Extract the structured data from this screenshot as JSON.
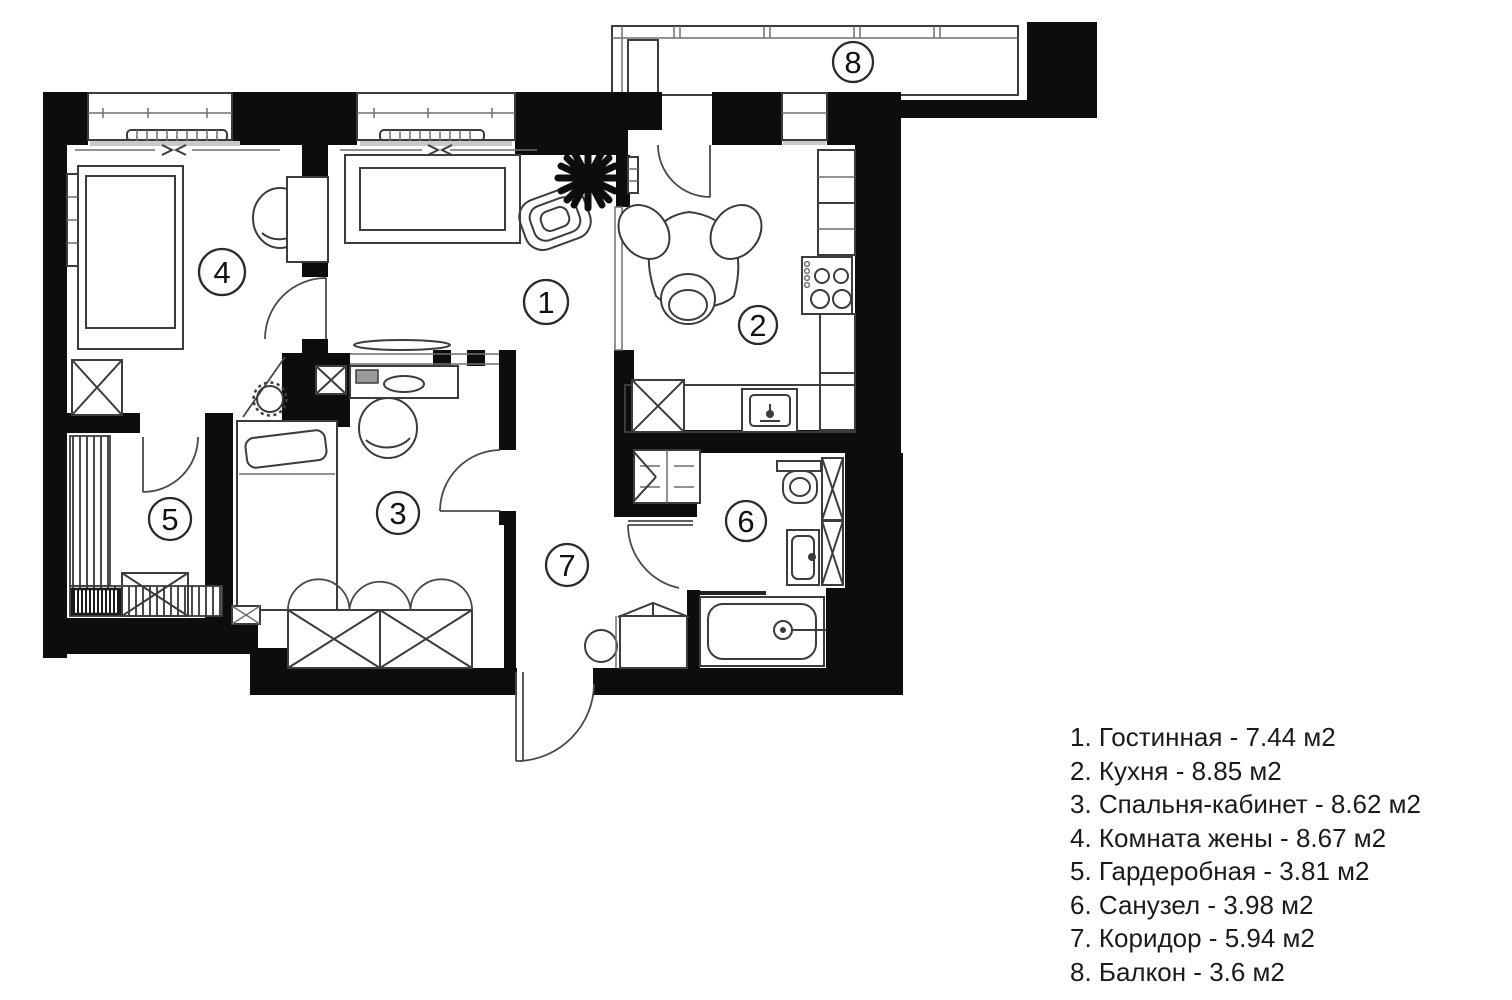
{
  "colors": {
    "wall": "#0d0d0d",
    "furniture_line": "#3c3c3c",
    "text": "#1b1b1b",
    "background": "#ffffff"
  },
  "area_unit": "м2",
  "rooms": [
    {
      "number": "1",
      "name": "Гостинная",
      "area_m2": "7.44",
      "legend_text": "1. Гостинная - 7.44 м2"
    },
    {
      "number": "2",
      "name": "Кухня",
      "area_m2": "8.85",
      "legend_text": "2. Кухня - 8.85 м2"
    },
    {
      "number": "3",
      "name": "Спальня-кабинет",
      "area_m2": "8.62",
      "legend_text": "3. Спальня-кабинет - 8.62 м2"
    },
    {
      "number": "4",
      "name": "Комната жены",
      "area_m2": "8.67",
      "legend_text": "4. Комната жены - 8.67 м2"
    },
    {
      "number": "5",
      "name": "Гардеробная",
      "area_m2": "3.81",
      "legend_text": "5. Гардеробная - 3.81 м2"
    },
    {
      "number": "6",
      "name": "Санузел",
      "area_m2": "3.98",
      "legend_text": "6. Санузел - 3.98 м2"
    },
    {
      "number": "7",
      "name": "Коридор",
      "area_m2": "5.94",
      "legend_text": "7. Коридор - 5.94 м2"
    },
    {
      "number": "8",
      "name": "Балкон",
      "area_m2": "3.6",
      "legend_text": "8. Балкон - 3.6 м2"
    }
  ]
}
